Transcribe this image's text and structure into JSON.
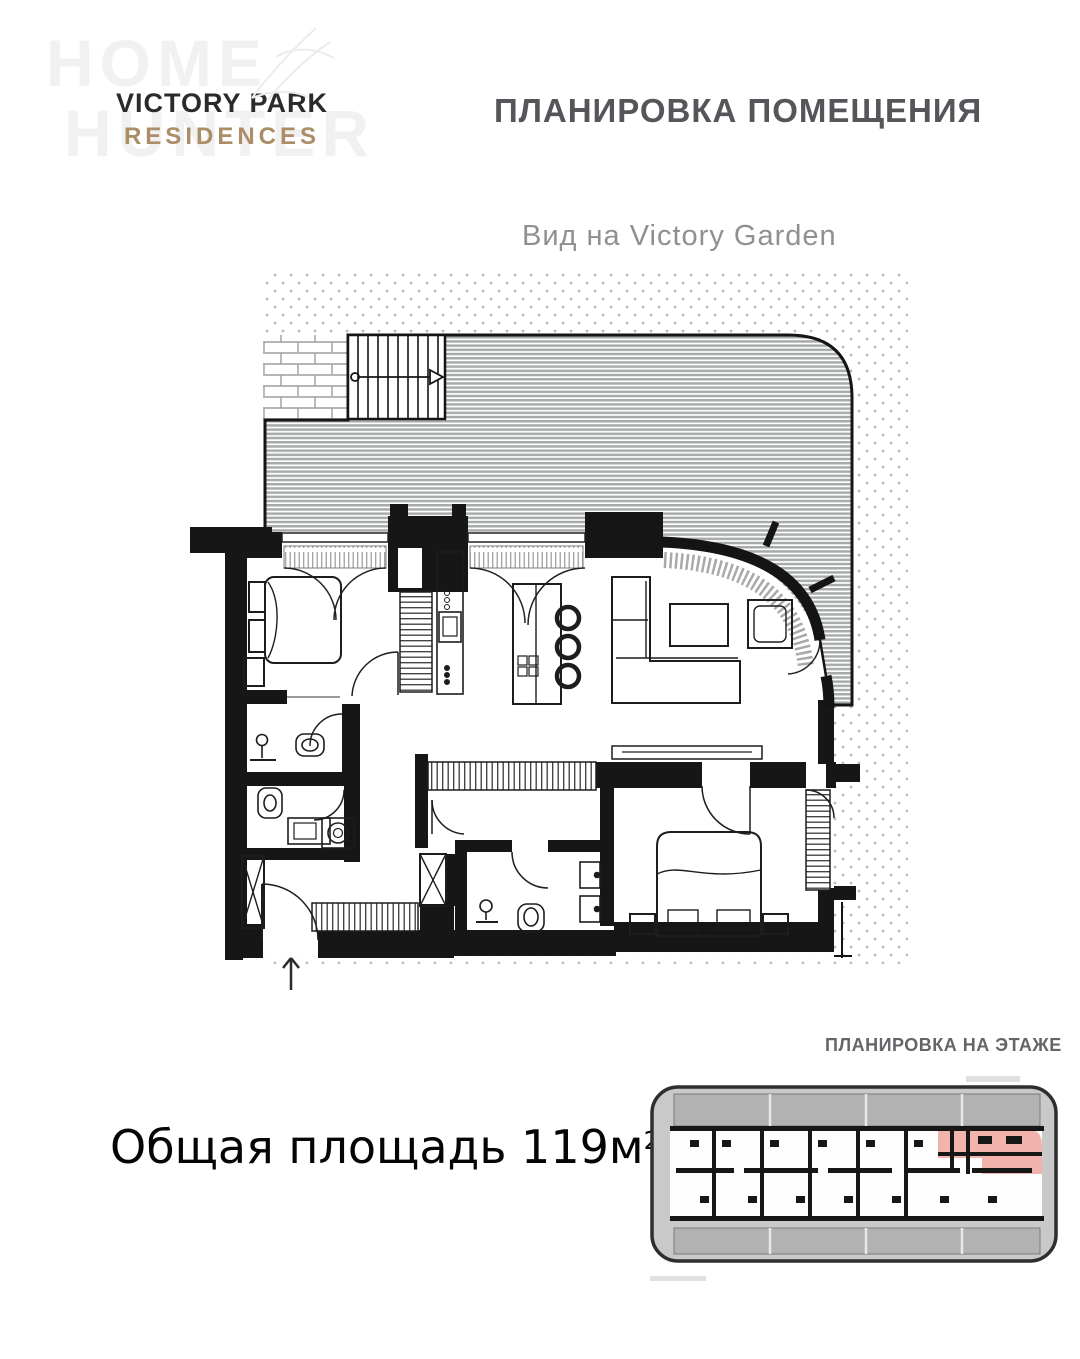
{
  "brand": {
    "name_line1": "VICTORY PARK",
    "name_line2": "RESIDENCES"
  },
  "watermark": {
    "line1": "HOME",
    "line2": "HUNTER"
  },
  "header": {
    "title": "ПЛАНИРОВКА ПОМЕЩЕНИЯ"
  },
  "plan": {
    "view_label": "Вид на Victory Garden"
  },
  "floor_section": {
    "label": "ПЛАНИРОВКА НА ЭТАЖЕ"
  },
  "area": {
    "text": "Общая площадь 119м",
    "sup": "2"
  },
  "colors": {
    "brand_gold": "#ab8d68",
    "title_gray": "#55565a",
    "label_gray": "#909094",
    "floor_label_gray": "#636568",
    "highlight_pink": "#f2b3ad",
    "deck_stripe_gray": "#a7abab",
    "dot_gray": "#bababa",
    "wall_black": "#161616"
  }
}
